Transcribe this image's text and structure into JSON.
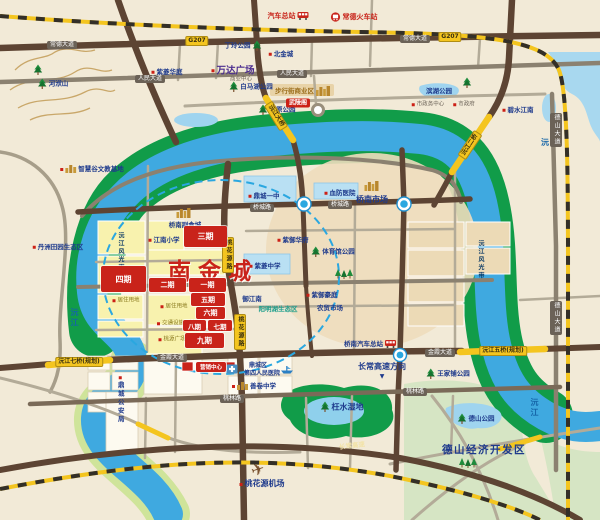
{
  "map": {
    "project_title": "南金城",
    "colors": {
      "land": "#f2ead7",
      "river": "#3fa9e0",
      "bank_green": "#119c49",
      "road_major": "#5d4433",
      "road_secondary": "#8b8170",
      "highway_yellow": "#f4c51f",
      "project_red": "#c9231a",
      "radius_circle_blue": "#2aa7e0",
      "eco_pale_green": "#d6e5c4"
    },
    "phases": [
      {
        "label": "三期",
        "x": 184,
        "y": 226,
        "w": 43,
        "h": 21
      },
      {
        "label": "四期",
        "x": 101,
        "y": 266,
        "w": 45,
        "h": 26
      },
      {
        "label": "二期",
        "x": 149,
        "y": 278,
        "w": 37,
        "h": 14,
        "fs": 7
      },
      {
        "label": "一期",
        "x": 189,
        "y": 278,
        "w": 37,
        "h": 14,
        "fs": 7
      },
      {
        "label": "五期",
        "x": 191,
        "y": 293,
        "w": 34,
        "h": 13,
        "fs": 7
      },
      {
        "label": "六期",
        "x": 196,
        "y": 307,
        "w": 29,
        "h": 12,
        "fs": 7
      },
      {
        "label": "八期",
        "x": 183,
        "y": 320,
        "w": 23,
        "h": 11,
        "fs": 6.5
      },
      {
        "label": "七期",
        "x": 208,
        "y": 320,
        "w": 24,
        "h": 11,
        "fs": 6.5
      },
      {
        "label": "九期",
        "x": 185,
        "y": 333,
        "w": 39,
        "h": 15,
        "fs": 7.5
      },
      {
        "label": "营销中心",
        "x": 196,
        "y": 362,
        "w": 30,
        "h": 10,
        "fs": 5.5
      }
    ],
    "labels": [
      {
        "t": "汽车总站",
        "x": 288,
        "y": 16,
        "c": "c-red",
        "icon": "bus-icon",
        "ipos": "after",
        "name": "bus-terminal-label"
      },
      {
        "t": "常德火车站",
        "x": 354,
        "y": 17,
        "c": "c-red",
        "icon": "train-icon",
        "ipos": "before",
        "name": "railway-station-label"
      },
      {
        "t": "丁玲公园",
        "x": 243,
        "y": 46,
        "c": "c-navy",
        "icon": "tree-icon",
        "ipos": "after"
      },
      {
        "t": "北金城",
        "x": 281,
        "y": 54,
        "c": "c-navy",
        "dot": 1
      },
      {
        "t": "万达广场",
        "x": 233,
        "y": 71,
        "c": "c-purple",
        "dot": 1,
        "name": "wanda-plaza-label"
      },
      {
        "t": "商业中心",
        "x": 241,
        "y": 80,
        "c": "c-small"
      },
      {
        "t": "紫菱华庭",
        "x": 167,
        "y": 72,
        "c": "c-navy",
        "dot": 1
      },
      {
        "t": "白马湖公园",
        "x": 251,
        "y": 87,
        "c": "c-navy",
        "icon": "tree-icon",
        "ipos": "before"
      },
      {
        "t": "屈原公园",
        "x": 277,
        "y": 110,
        "c": "c-navy",
        "icon": "tree-icon",
        "ipos": "before"
      },
      {
        "t": "",
        "x": 38,
        "y": 70,
        "icon": "tree-icon"
      },
      {
        "t": "河洑山",
        "x": 53,
        "y": 84,
        "c": "c-navy",
        "icon": "tree-icon",
        "ipos": "before"
      },
      {
        "t": "智慧谷文教基地",
        "x": 92,
        "y": 169,
        "c": "c-navy",
        "dot": 1,
        "icon": "building-icon",
        "ipos": "before"
      },
      {
        "t": "丹洲田园生态区",
        "x": 58,
        "y": 247,
        "c": "c-navy",
        "dot": 1
      },
      {
        "t": "武陵阁",
        "x": 298,
        "y": 103,
        "c": "chip",
        "name": "wulingge-chip"
      },
      {
        "t": "步行街商业区",
        "x": 303,
        "y": 91,
        "c": "c-gold",
        "icon": "skyline-gold-icon",
        "ipos": "after"
      },
      {
        "t": "滨湖公园",
        "x": 439,
        "y": 91,
        "c": "c-navy"
      },
      {
        "t": "",
        "x": 467,
        "y": 83,
        "icon": "tree-icon"
      },
      {
        "t": "市政务中心",
        "x": 428,
        "y": 105,
        "c": "c-small",
        "dot": 1
      },
      {
        "t": "市政府",
        "x": 464,
        "y": 105,
        "c": "c-small",
        "dot": 1
      },
      {
        "t": "碧水江南",
        "x": 518,
        "y": 110,
        "c": "c-navy",
        "dot": 1
      },
      {
        "t": "",
        "x": 184,
        "y": 213,
        "icon": "skyline-gold-icon"
      },
      {
        "t": "桥南副食城",
        "x": 185,
        "y": 225,
        "c": "c-navy"
      },
      {
        "t": "江南小学",
        "x": 164,
        "y": 240,
        "c": "c-navy",
        "dot": 1
      },
      {
        "t": "鼎城一中",
        "x": 264,
        "y": 196,
        "c": "c-navy",
        "dot": 1
      },
      {
        "t": "血防医院",
        "x": 340,
        "y": 193,
        "c": "c-navy",
        "dot": 1
      },
      {
        "t": "",
        "x": 372,
        "y": 186,
        "icon": "skyline-gold-icon"
      },
      {
        "t": "桥南市场",
        "x": 372,
        "y": 200,
        "c": "c-navy c-navy-lg"
      },
      {
        "t": "紫御华府",
        "x": 293,
        "y": 240,
        "c": "c-navy",
        "dot": 1
      },
      {
        "t": "紫菱中学",
        "x": 265,
        "y": 266,
        "c": "c-navy",
        "dot": 1
      },
      {
        "t": "体育馆公园",
        "x": 333,
        "y": 252,
        "c": "c-navy",
        "icon": "tree-icon",
        "ipos": "before"
      },
      {
        "t": "",
        "x": 344,
        "y": 274,
        "icon": "trees-icon"
      },
      {
        "t": "御江南",
        "x": 252,
        "y": 299,
        "c": "c-navy"
      },
      {
        "t": "阳明湖生态区",
        "x": 278,
        "y": 309,
        "c": "c-teal"
      },
      {
        "t": "紫御豪庭",
        "x": 322,
        "y": 295,
        "c": "c-navy",
        "dot": 1
      },
      {
        "t": "农贸市场",
        "x": 330,
        "y": 308,
        "c": "c-navy"
      },
      {
        "t": "桥南汽车总站",
        "x": 370,
        "y": 344,
        "c": "c-navy",
        "icon": "bus-icon",
        "ipos": "after"
      },
      {
        "t": "长常高速方向",
        "x": 382,
        "y": 367,
        "c": "c-navy c-navy-lg"
      },
      {
        "t": "▼",
        "x": 382,
        "y": 377,
        "c": "c-navy c-arrow",
        "name": "arrow-down-icon"
      },
      {
        "t": "",
        "x": 232,
        "y": 369,
        "icon": "hospital-icon"
      },
      {
        "t": "鼎城区",
        "x": 258,
        "y": 366,
        "c": "c-navy c-sm7"
      },
      {
        "t": "第四人民医院",
        "x": 262,
        "y": 374,
        "c": "c-navy c-sm7"
      },
      {
        "t": "善卷中学",
        "x": 254,
        "y": 386,
        "c": "c-navy",
        "dot": 1,
        "icon": "building-icon",
        "ipos": "before"
      },
      {
        "t": "鼎城公安局",
        "x": 120,
        "y": 400,
        "c": "c-navy vert",
        "dot": 1
      },
      {
        "t": "居住用地",
        "x": 126,
        "y": 301,
        "c": "c-olive",
        "dot": 1
      },
      {
        "t": "居住用地",
        "x": 174,
        "y": 307,
        "c": "c-olive",
        "dot": 1
      },
      {
        "t": "交通设施用地",
        "x": 176,
        "y": 324,
        "c": "c-olive",
        "dot": 1
      },
      {
        "t": "桃源广场",
        "x": 172,
        "y": 340,
        "c": "c-olive",
        "dot": 1
      },
      {
        "t": "",
        "x": 287,
        "y": 370,
        "icon": "ship-icon"
      },
      {
        "t": "枉水湿地",
        "x": 342,
        "y": 407,
        "c": "c-navy c-navy-lg",
        "icon": "tree-icon",
        "ipos": "before"
      },
      {
        "t": "",
        "x": 258,
        "y": 470,
        "icon": "plane-icon"
      },
      {
        "t": "桃花源机场",
        "x": 262,
        "y": 484,
        "c": "c-navy c-navy-lg",
        "dot": 1
      },
      {
        "t": "德山公园",
        "x": 476,
        "y": 419,
        "c": "c-navy",
        "icon": "tree-icon",
        "ipos": "before"
      },
      {
        "t": "德山经济开发区",
        "x": 484,
        "y": 450,
        "c": "c-navy c-navy-xl"
      },
      {
        "t": "",
        "x": 468,
        "y": 463,
        "icon": "trees-icon"
      },
      {
        "t": "王家铺公园",
        "x": 448,
        "y": 374,
        "c": "c-navy",
        "icon": "tree-icon",
        "ipos": "before"
      },
      {
        "t": "沅江",
        "x": 74,
        "y": 318,
        "c": "c-river vert",
        "name": "river-label"
      },
      {
        "t": "沅江",
        "x": 534,
        "y": 408,
        "c": "c-river vert",
        "name": "river-label"
      },
      {
        "t": "沅江",
        "x": 552,
        "y": 143,
        "c": "c-river",
        "name": "river-label"
      },
      {
        "t": "沅江风光带",
        "x": 120,
        "y": 252,
        "c": "c-band vert"
      },
      {
        "t": "沅江风光带",
        "x": 480,
        "y": 260,
        "c": "c-band vert"
      },
      {
        "t": "常德大道",
        "x": 62,
        "y": 45,
        "c": "plate",
        "name": "road-plate"
      },
      {
        "t": "常德大道",
        "x": 415,
        "y": 39,
        "c": "plate",
        "name": "road-plate"
      },
      {
        "t": "G207",
        "x": 197,
        "y": 41,
        "c": "plate-y",
        "name": "road-plate"
      },
      {
        "t": "G207",
        "x": 450,
        "y": 37,
        "c": "plate-y",
        "name": "road-plate"
      },
      {
        "t": "人民大道",
        "x": 150,
        "y": 79,
        "c": "plate",
        "name": "road-plate"
      },
      {
        "t": "人民大道",
        "x": 292,
        "y": 74,
        "c": "plate",
        "name": "road-plate"
      },
      {
        "t": "桥城路",
        "x": 262,
        "y": 208,
        "c": "plate",
        "name": "road-plate"
      },
      {
        "t": "桥城路",
        "x": 340,
        "y": 205,
        "c": "plate",
        "name": "road-plate"
      },
      {
        "t": "金霞大道",
        "x": 172,
        "y": 358,
        "c": "plate",
        "name": "road-plate"
      },
      {
        "t": "金霞大道",
        "x": 440,
        "y": 353,
        "c": "plate",
        "name": "road-plate"
      },
      {
        "t": "桃林路",
        "x": 232,
        "y": 399,
        "c": "plate",
        "name": "road-plate"
      },
      {
        "t": "桃林路",
        "x": 415,
        "y": 392,
        "c": "plate",
        "name": "road-plate"
      },
      {
        "t": "桃花源路",
        "x": 228,
        "y": 255,
        "c": "plate-y vert",
        "name": "road-plate"
      },
      {
        "t": "桃花源路",
        "x": 240,
        "y": 332,
        "c": "plate-y vert",
        "name": "road-plate"
      },
      {
        "t": "德山大道",
        "x": 556,
        "y": 130,
        "c": "plate vert",
        "name": "road-plate"
      },
      {
        "t": "德山大道",
        "x": 556,
        "y": 318,
        "c": "plate vert",
        "name": "road-plate"
      },
      {
        "t": "沅江大桥",
        "x": 276,
        "y": 116,
        "c": "plate-y",
        "rot": 58,
        "name": "bridge-plate"
      },
      {
        "t": "沅江二桥",
        "x": 470,
        "y": 145,
        "c": "plate-y",
        "rot": -56,
        "name": "bridge-plate"
      },
      {
        "t": "沅江五桥(规划)",
        "x": 503,
        "y": 351,
        "c": "plate-y",
        "name": "bridge-plate"
      },
      {
        "t": "沅江七桥(规划)",
        "x": 79,
        "y": 362,
        "c": "plate-y",
        "name": "bridge-plate"
      },
      {
        "t": "长常高速",
        "x": 352,
        "y": 446,
        "c": "hw",
        "rot": -7,
        "name": "expressway-label"
      }
    ]
  }
}
